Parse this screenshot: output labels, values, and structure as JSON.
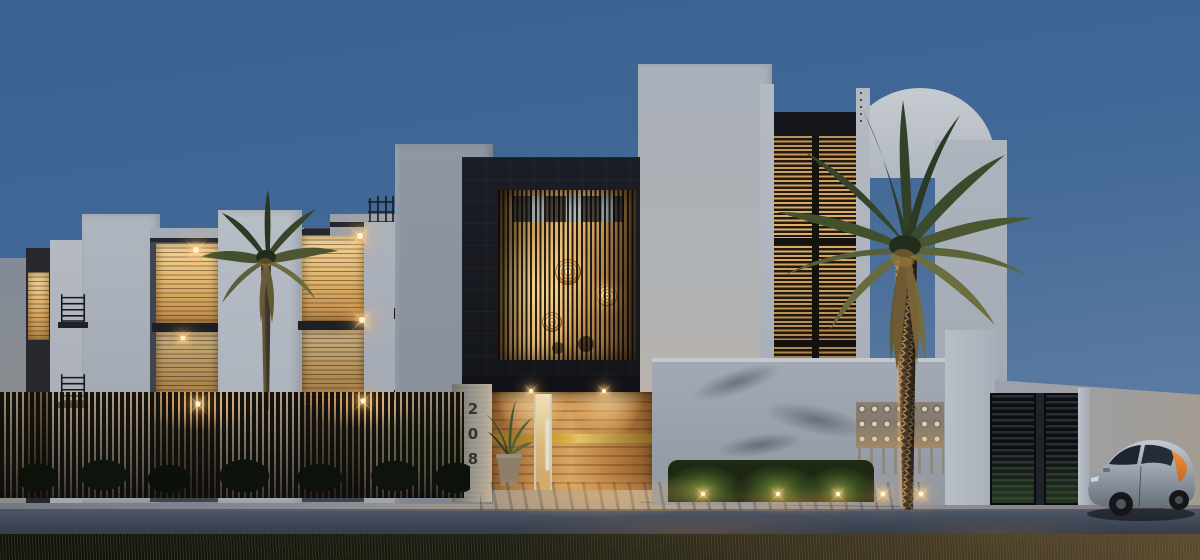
{
  "scene": {
    "type": "architectural-exterior-rendering",
    "time_of_day": "dusk",
    "address_number": "208",
    "colors": {
      "sky-top": "#3a6191",
      "sky-bottom": "#5a7aa1",
      "wall-light": "#c2c7ce",
      "wall-mid": "#a9afb9",
      "wall-shadow": "#8a93a0",
      "dark-cladding": "#171a20",
      "amber-bright": "#f2d9a2",
      "amber-mid": "#ddb169",
      "amber-deep": "#8a6336",
      "wood-light": "#d8a460",
      "wood-dark": "#8a5a2c",
      "brass": "#d4ab35",
      "fence-dark": "#12110e",
      "glow-warm": "#ffd9a0",
      "hedge-dark": "#1b2412",
      "hedge-lit": "#55752f",
      "palm-dark": "#2e3b24",
      "palm-lit": "#7c7f48",
      "trunk-warm": "#c79a5c",
      "road-dark": "#2b313e",
      "road-light": "#4a5362",
      "sidewalk": "#8a8f9a",
      "car-silver": "#9aa3ad",
      "car-orange": "#e07f28",
      "stone-pillar": "#8f8e88",
      "number-color": "#35332e"
    }
  }
}
